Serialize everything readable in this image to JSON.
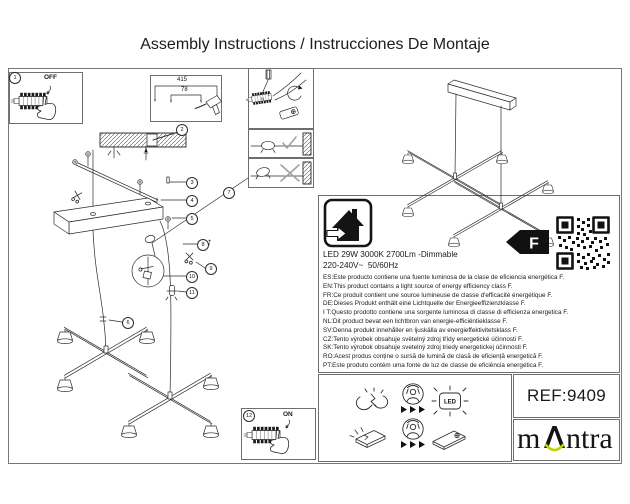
{
  "title": "Assembly Instructions / Instrucciones De Montaje",
  "callouts": {
    "c1": "1",
    "c2": "2",
    "c3": "3",
    "c4": "4",
    "c5": "5",
    "c6": "6",
    "c7": "7",
    "c8": "8",
    "c9": "9",
    "c10": "10",
    "c11": "11",
    "c12": "12"
  },
  "labels": {
    "off": "OFF",
    "on": "ON",
    "up_arrow": "↑",
    "dim_width": "415",
    "dim_holes": "78",
    "wire_n": "N",
    "wire_l": "L",
    "led": "LED"
  },
  "energy": {
    "spec_line1": "LED 29W 3000K 2700Lm -Dimmable",
    "spec_line2": "220-240V~  50/60Hz",
    "class": "F",
    "languages": [
      "ES:Este producto contiene una fuente luminosa de la clase de eficiencia energética F.",
      "EN:This product contains a light source of energy efficiency class F.",
      "FR:Ce produit contient une source lumineuse de classe d'efficacité énergétique F.",
      "DE:Dieses Produkt enthält eine Lichtquelle der Energieeffizienzklasse F.",
      "I T:Questo prodotto contiene una sorgente luminosa di classe di efficienza energetica F.",
      "NL:Dit product bevat een lichtbron van energie-efficiëntieklasse F.",
      "SV:Denna produkt innehåller en ljuskälla av energieffektivitetsklass F.",
      "CZ:Tento výrobek obsahuje světelný zdroj třídy energetické účinnosti F.",
      "SK:Tento výrobok obsahuje svetelný zdroj triedy energetickej účinnosti F.",
      "RO:Acest produs conține o sursă de lumină de clasă de eficiență energetică F.",
      "PT:Este produto contém uma fonte de luz de classe de eficiência energética F."
    ]
  },
  "footer": {
    "ref": "REF:9409",
    "brand_part1": "m",
    "brand_part2": "ntra"
  },
  "colors": {
    "brand_accent": "#bfd100"
  }
}
